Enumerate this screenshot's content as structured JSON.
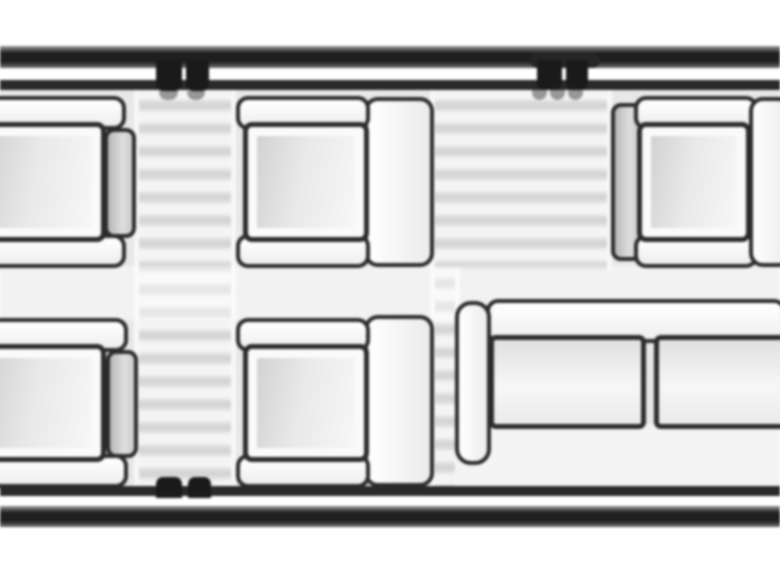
{
  "diagram": {
    "kind": "aircraft cabin seating plan, overhead view (cropped section)",
    "visible_text": "",
    "walls": {
      "top": "double hull line",
      "bottom": "double hull line",
      "door_markers": [
        {
          "wall": "top",
          "location": "left of center",
          "marks": 2
        },
        {
          "wall": "top",
          "location": "right of center",
          "marks": 2
        },
        {
          "wall": "bottom",
          "location": "left of center",
          "marks": 2
        }
      ]
    },
    "entry_areas": [
      {
        "style": "striped band",
        "location": "between left and center seats, full cabin height"
      },
      {
        "style": "striped band",
        "location": "between center and right seats, upper half plus narrow lower strip"
      }
    ],
    "furniture": {
      "top_row": [
        {
          "type": "club seat",
          "clipped": "left edge",
          "side_bar": "right"
        },
        {
          "type": "club seat",
          "backrest": "right"
        },
        {
          "type": "club seat",
          "backrest": "left"
        },
        {
          "type": "seat backrest",
          "clipped": "right edge"
        }
      ],
      "bottom_row": [
        {
          "type": "club seat",
          "clipped": "left edge",
          "side_bar": "right"
        },
        {
          "type": "club seat",
          "backrest": "right"
        },
        {
          "type": "divan sofa",
          "visible_cushions": 2,
          "armrest": "left",
          "clipped": "right edge"
        }
      ]
    },
    "palette": {
      "exterior": "#ffffff",
      "hull_outline": "#1f1f1f",
      "cabin_floor": "#e8e8e8",
      "furniture_fill": "#fbfbfb",
      "furniture_outline": "#2b2b2b",
      "stripe_light": "#f4f4f4",
      "stripe_dark": "#d6d6d6"
    }
  }
}
